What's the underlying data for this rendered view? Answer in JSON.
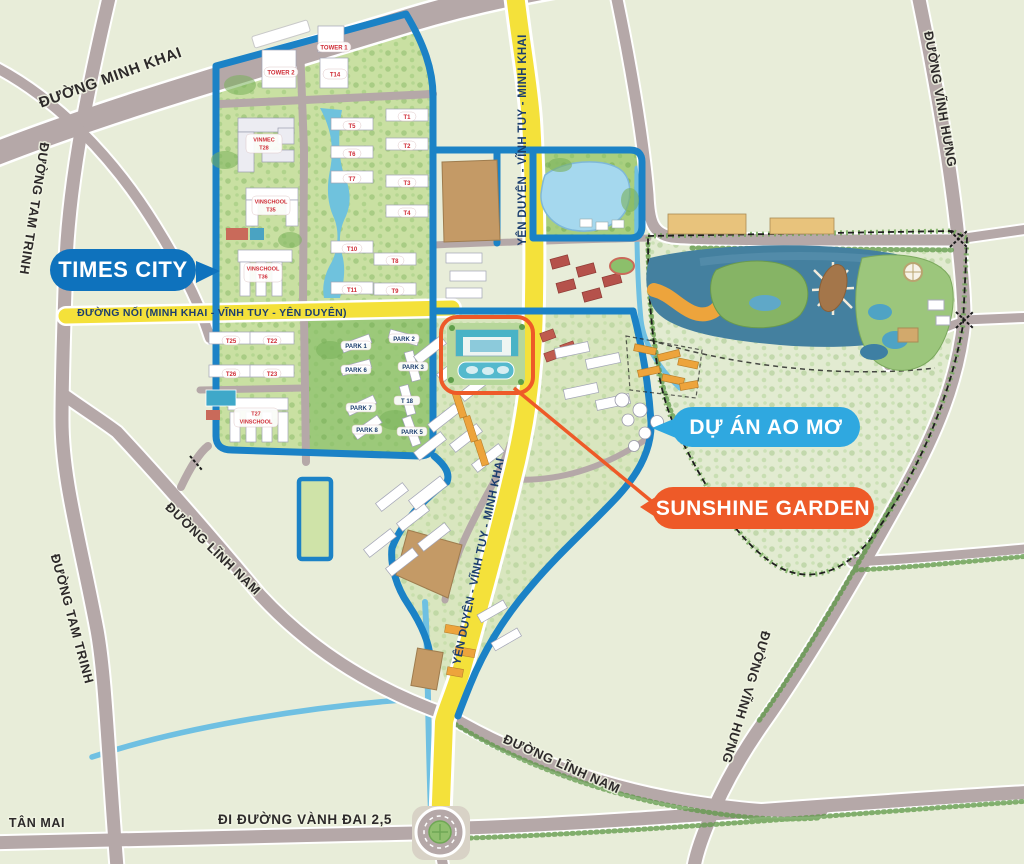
{
  "areas": {
    "times_city": "TIMES CITY",
    "ao_mo": "DỰ ÁN AO MƠ",
    "sunshine_garden": "SUNSHINE GARDEN"
  },
  "roads": {
    "minh_khai": "ĐƯỜNG MINH KHAI",
    "tam_trinh": "ĐƯỜNG TAM TRINH",
    "vinh_hung": "ĐƯỜNG VĨNH HƯNG",
    "linh_nam": "ĐƯỜNG LĨNH NAM",
    "noi": "ĐƯỜNG NỐI (MINH KHAI - VĨNH TUY - YÊN DUYÊN)",
    "yen_duyen": "YÊN DUYÊN - VĨNH TUY - MINH KHAI",
    "vanh_dai_25": "ĐI ĐƯỜNG VÀNH ĐAI 2,5",
    "tan_mai": "TÂN MAI"
  },
  "times_city": {
    "tower1": "TOWER 1",
    "tower2": "TOWER 2",
    "t14": "T14",
    "vinmec_line1": "VINMEC",
    "vinmec_line2": "T28",
    "vinschool35_line1": "VINSCHOOL",
    "vinschool35_line2": "T35",
    "vinschool36_line1": "VINSCHOOL",
    "vinschool36_line2": "T36",
    "vinschool27_line1": "T27",
    "vinschool27_line2": "VINSCHOOL",
    "towers": [
      "T1",
      "T2",
      "T3",
      "T4",
      "T5",
      "T6",
      "T7",
      "T8",
      "T9",
      "T10",
      "T11"
    ],
    "left_towers": [
      "T25",
      "T22",
      "T26",
      "T23"
    ],
    "parks": [
      "PARK 1",
      "PARK 2",
      "PARK 3",
      "PARK 5",
      "PARK 6",
      "PARK 7",
      "PARK 8"
    ],
    "t18": "T 18"
  },
  "colors": {
    "land": "#e8edd9",
    "road_gray": "#b5a8a8",
    "yellow_road": "#f4e13a",
    "ring_road_blue": "#1b82c6",
    "times_city_pill": "#0e72bd",
    "ao_mo_pill": "#2fa8e0",
    "sunshine_orange": "#ee5a28",
    "water_light": "#9ed3ec",
    "water_dark": "#44809f",
    "rowhouse_orange": "#eda43c"
  }
}
